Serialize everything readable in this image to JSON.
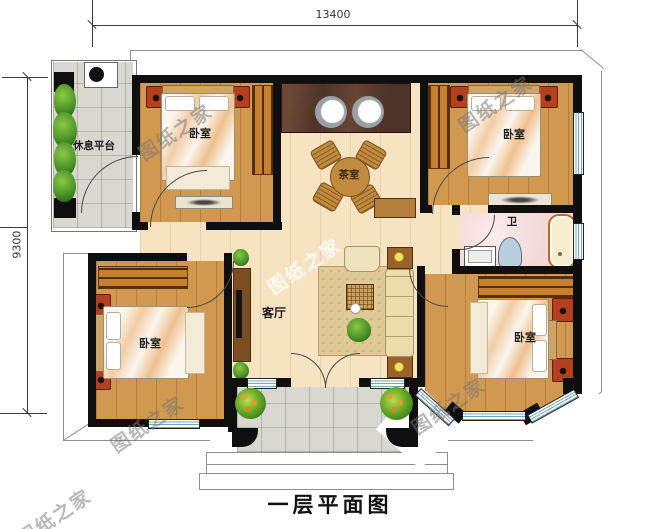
{
  "plan": {
    "caption": "一层平面图",
    "watermark": "图纸之家",
    "dimensions": {
      "top": "13400",
      "left": "9300"
    },
    "rooms": {
      "rest_platform": "休息平台",
      "bedroom_top_left": "卧室",
      "tea_room": "茶室",
      "bedroom_top_right": "卧室",
      "bathroom": "卫",
      "bedroom_bottom_left": "卧室",
      "living_room": "客厅",
      "bedroom_bottom_right": "卧室"
    },
    "colors": {
      "wood_light": "#f7e3c2",
      "wood_mid": "#d19850",
      "wall": "#0f0f0f",
      "bath_pink": "#f3d8d6",
      "tile_gray": "#d8d7d0",
      "window_blue": "#6fa8ba"
    }
  }
}
